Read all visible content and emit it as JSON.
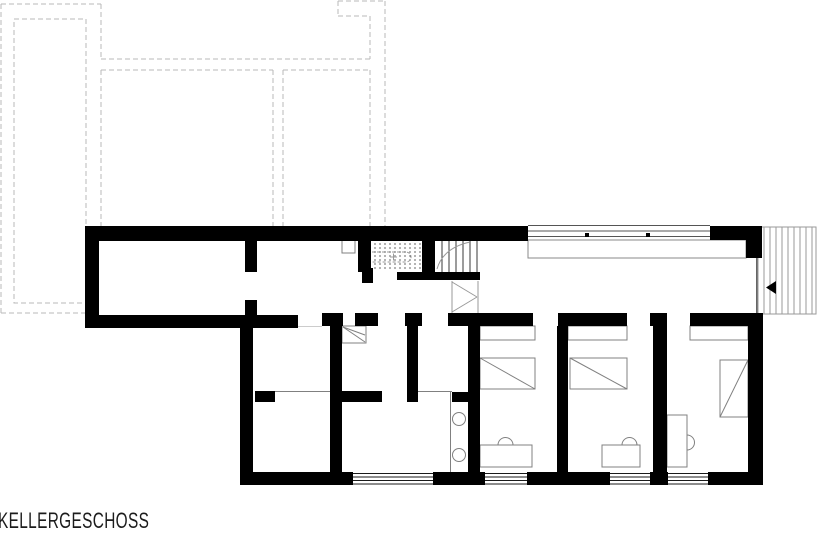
{
  "title": {
    "label": "KELLERGESCHOSS"
  },
  "colors": {
    "wall": "#000000",
    "thin_fixture_line": "#808080",
    "stair_tread": "#3a3a3a",
    "dashed_upper_floor_outline": "#b8b8b8",
    "window_line": "#1a1a1a",
    "background": "#ffffff"
  },
  "plan": {
    "type": "architectural-floor-plan",
    "level_label": "KELLERGESCHOSS",
    "features": [
      "dashed-upper-floor-projection",
      "storage-room-left",
      "storage-room-middle",
      "staircase-double-flight",
      "garage-with-sectional-door",
      "driveway-ramp-hatched",
      "entry-direction-arrow",
      "three-bedrooms-with-closet-bed-desk",
      "washbasin-shaft-circles",
      "cellar-rooms",
      "bottom-wall-windows"
    ]
  }
}
